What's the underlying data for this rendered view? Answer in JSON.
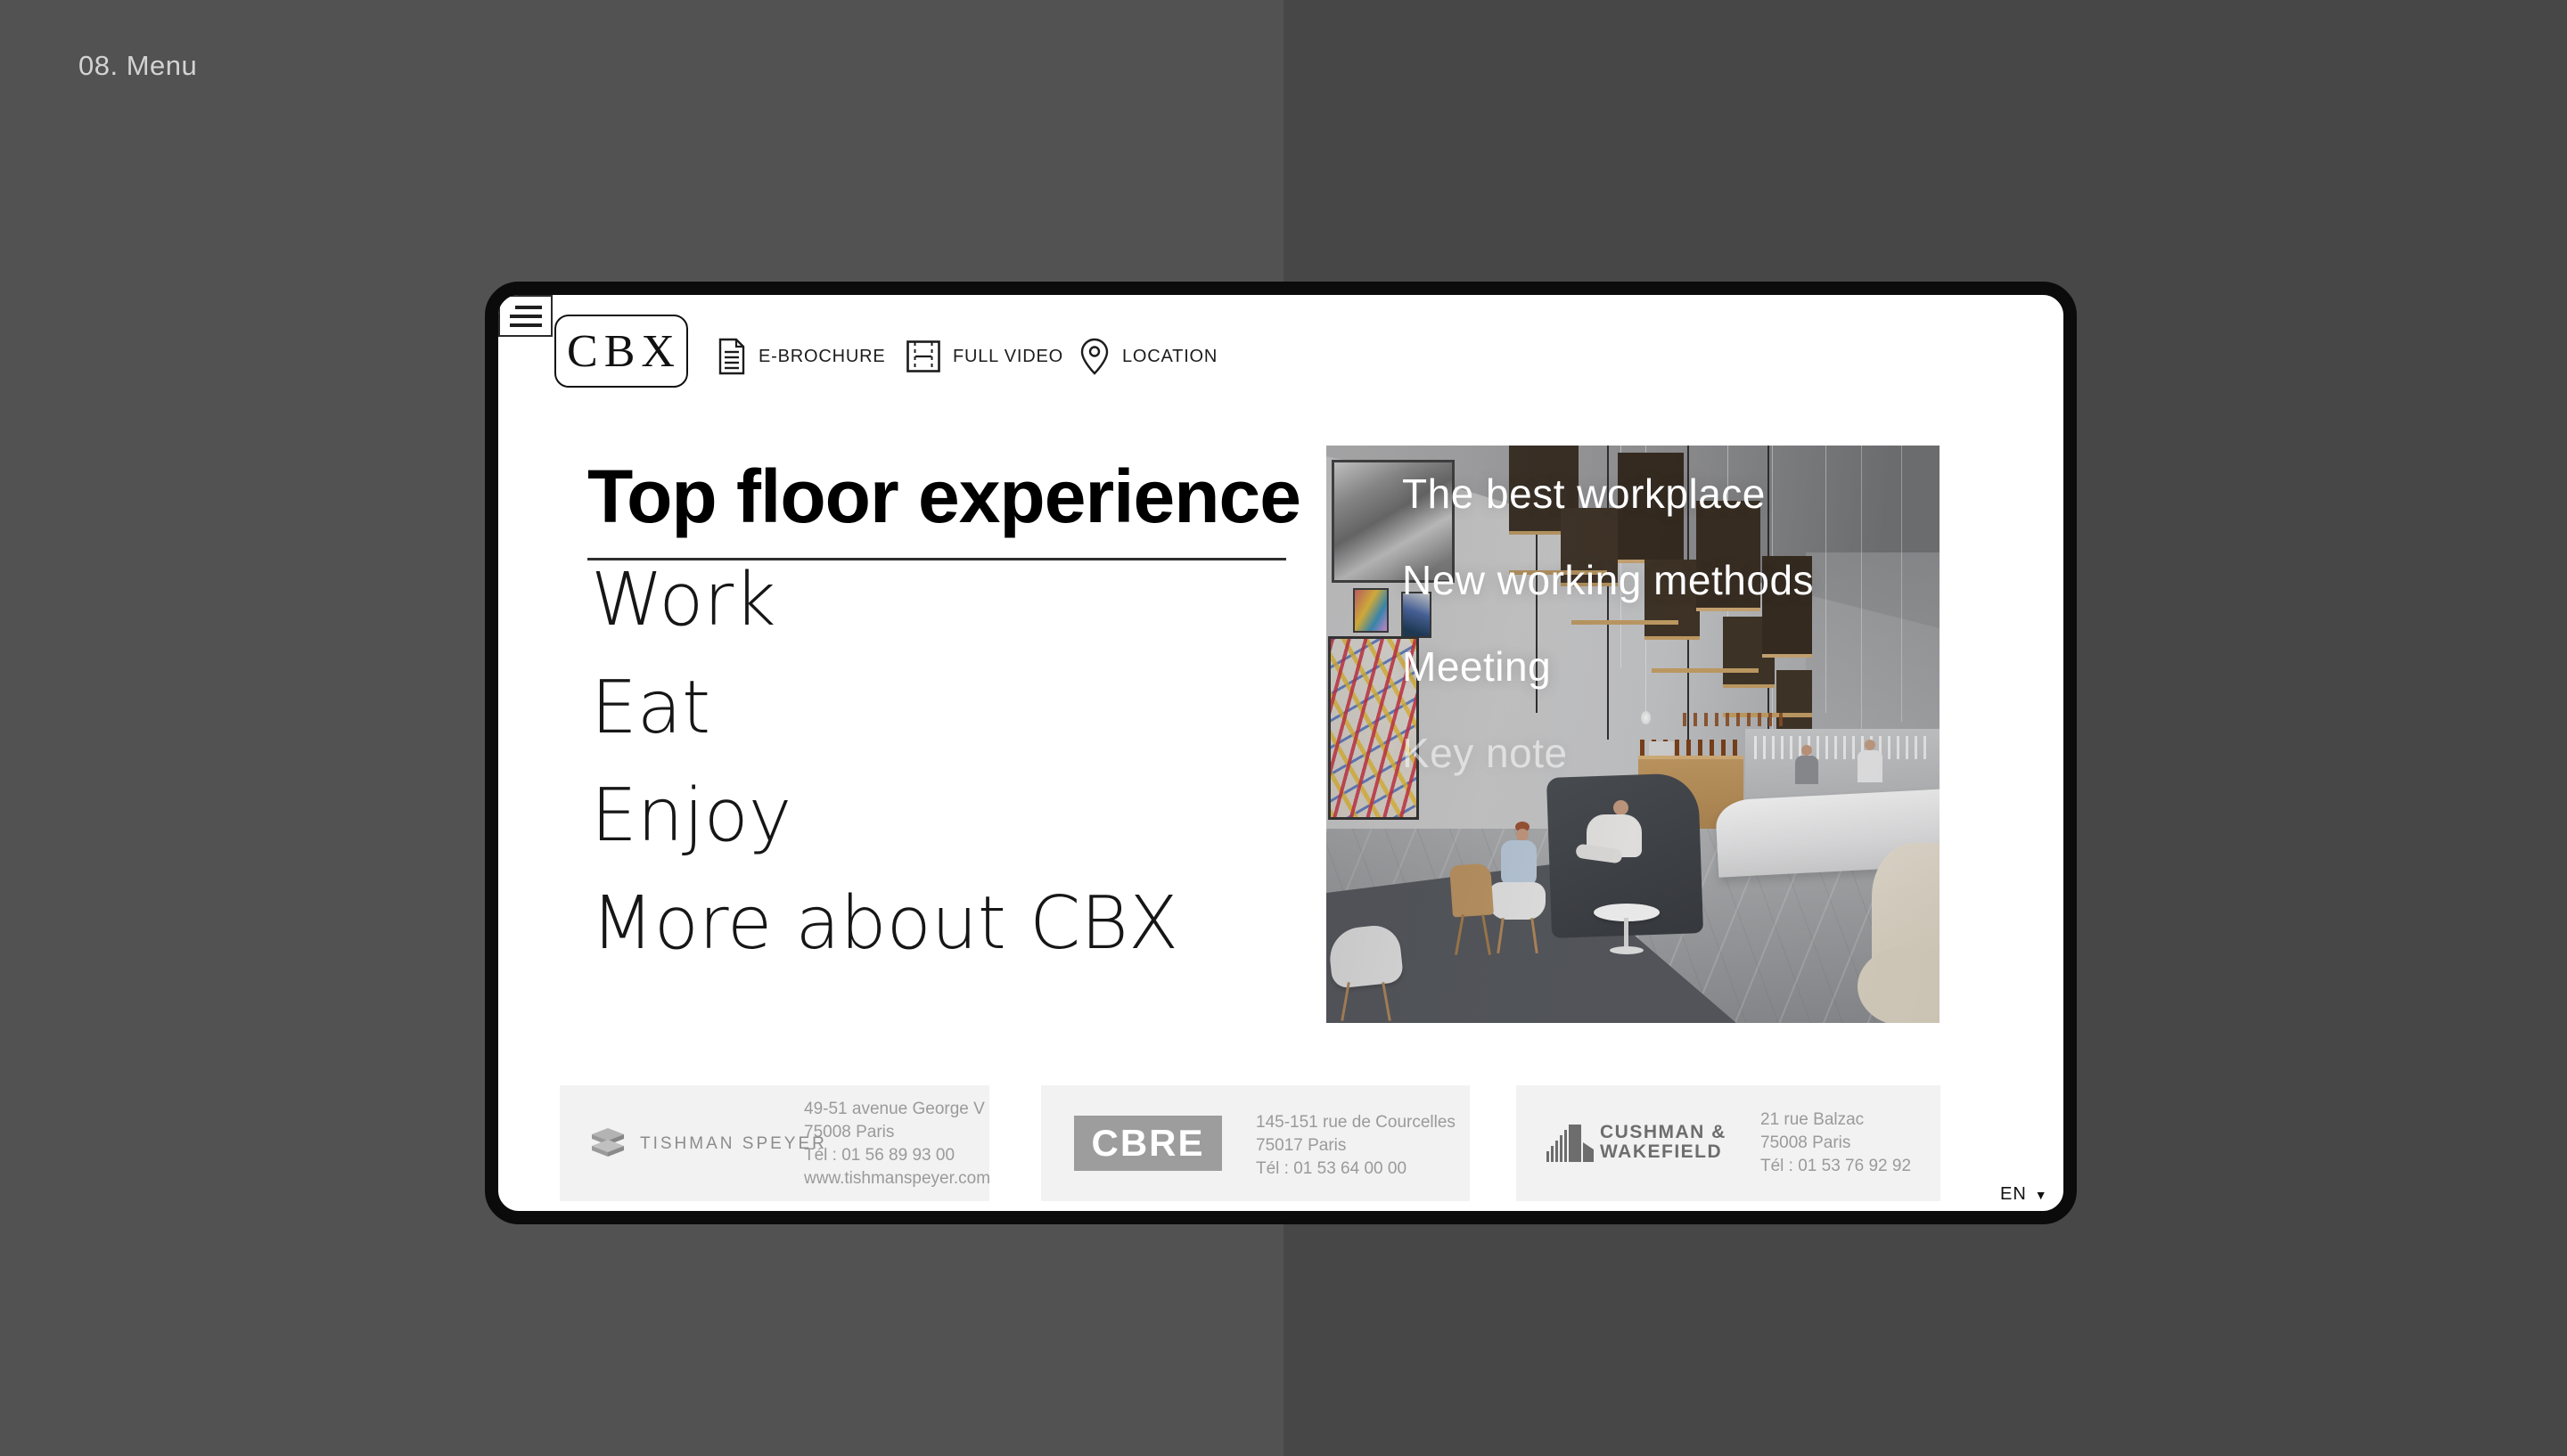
{
  "page_label": "08. Menu",
  "header": {
    "logo_text": "CBX",
    "nav": [
      {
        "label": "E-BROCHURE",
        "icon": "document-icon"
      },
      {
        "label": "FULL VIDEO",
        "icon": "film-icon"
      },
      {
        "label": "LOCATION",
        "icon": "map-pin-icon"
      }
    ],
    "menu_icon": "hamburger-icon"
  },
  "menu": {
    "title": "Top floor experience",
    "items": [
      "Work",
      "Eat",
      "Enjoy",
      "More about CBX"
    ]
  },
  "hero": {
    "overlay_items": [
      {
        "label": "The best workplace",
        "state": "normal"
      },
      {
        "label": "New working methods",
        "state": "normal"
      },
      {
        "label": "Meeting",
        "state": "normal"
      },
      {
        "label": "Key note",
        "state": "faded"
      }
    ]
  },
  "partners": [
    {
      "name": "Tishman Speyer",
      "logo_text": "TISHMAN SPEYER",
      "logo_icon": "stacked-slabs-icon",
      "lines": [
        "49-51 avenue George V",
        "75008 Paris",
        "Tél : 01 56 89 93 00",
        "www.tishmanspeyer.com"
      ]
    },
    {
      "name": "CBRE",
      "logo_text": "CBRE",
      "lines": [
        "145-151 rue de Courcelles",
        "75017 Paris",
        "Tél : 01 53 64 00 00"
      ]
    },
    {
      "name": "Cushman & Wakefield",
      "logo_line1": "CUSHMAN &",
      "logo_line2": "WAKEFIELD",
      "logo_icon": "skyline-bars-icon",
      "lines": [
        "21 rue Balzac",
        "75008 Paris",
        "Tél : 01 53 76 92 92"
      ]
    }
  ],
  "language": {
    "current": "EN",
    "caret": "▼"
  },
  "colors": {
    "background_left": "#525252",
    "background_right": "#474747",
    "card_frame": "#0b0b0b",
    "card_bg": "#ffffff",
    "partner_card_bg": "#f2f2f2",
    "muted_gray": "#9a9a9a",
    "text_dark": "#1c1c1c"
  }
}
